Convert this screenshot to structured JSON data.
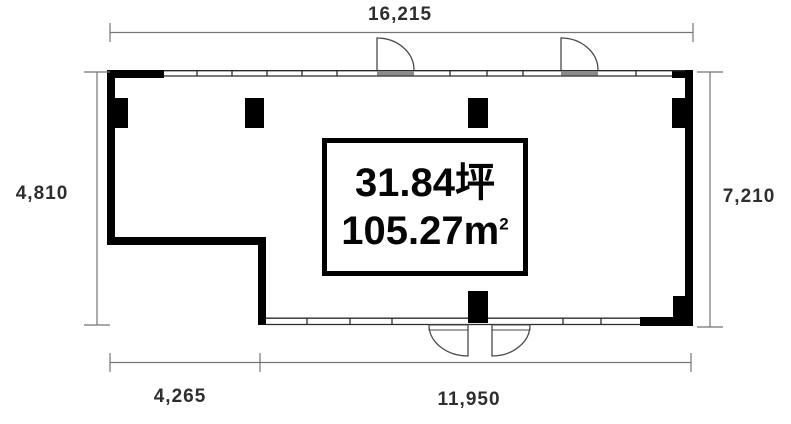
{
  "dimensions": {
    "top": "16,215",
    "left": "4,810",
    "right": "7,210",
    "bottom_left": "4,265",
    "bottom_right": "11,950"
  },
  "area": {
    "tsubo": "31.84坪",
    "sqm": "105.27m",
    "sqm_superscript": "2"
  },
  "colors": {
    "wall": "#000000",
    "window_line": "#2b2b2b",
    "door_line": "#4a4a4a",
    "dimension_line": "#757575",
    "label_text": "#2e2e2e",
    "background": "#ffffff"
  }
}
